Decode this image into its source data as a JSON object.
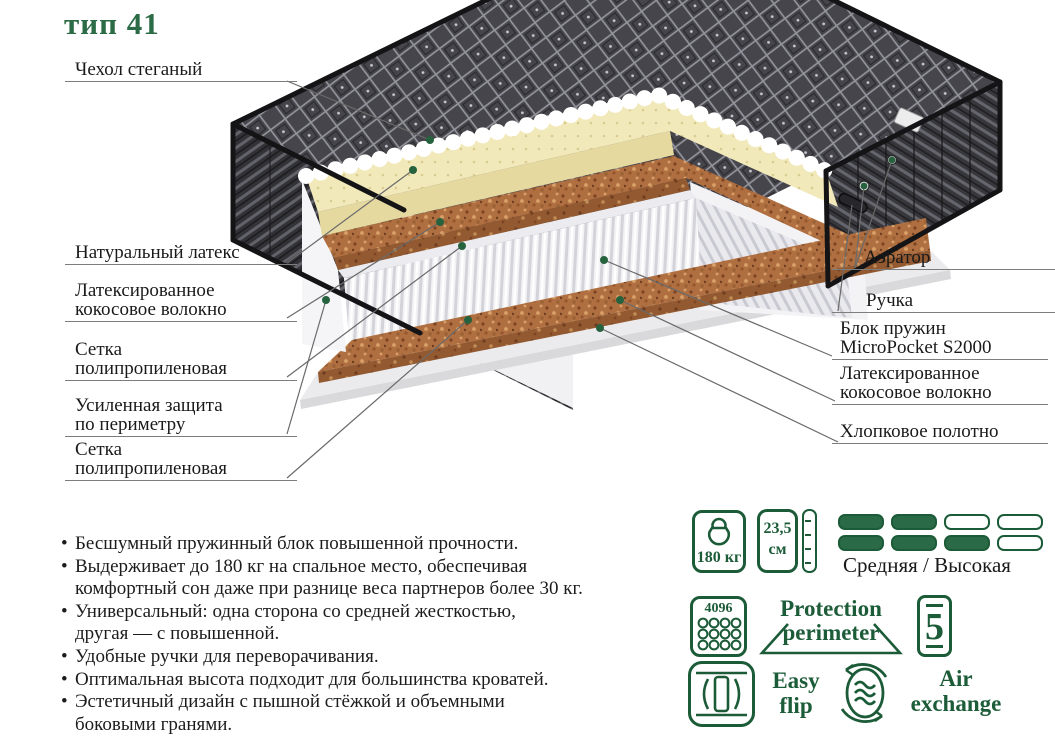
{
  "title": "тип 41",
  "labels_left": [
    [
      "Чехол стеганый"
    ],
    [
      "Натуральный латекс"
    ],
    [
      "Латексированное",
      "кокосовое волокно"
    ],
    [
      "Сетка",
      "полипропиленовая"
    ],
    [
      "Усиленная защита",
      "по периметру"
    ],
    [
      "Сетка",
      "полипропиленовая"
    ]
  ],
  "labels_right": [
    [
      "Аэратор"
    ],
    [
      "Ручка"
    ],
    [
      "Блок пружин",
      "MicroPocket S2000"
    ],
    [
      "Латексированное",
      "кокосовое волокно"
    ],
    [
      "Хлопковое полотно"
    ]
  ],
  "bullets": [
    [
      "Бесшумный пружинный блок повышенной прочности."
    ],
    [
      "Выдерживает до 180 кг на спальное место, обеспечивая",
      "комфортный сон даже при разнице веса партнеров более 30 кг."
    ],
    [
      "Универсальный: одна сторона со средней жесткостью,",
      "другая — с повышенной."
    ],
    [
      "Удобные ручки для переворачивания."
    ],
    [
      "Оптимальная высота подходит для большинства кроватей."
    ],
    [
      "Эстетичный дизайн с пышной стёжкой и объемными",
      "боковыми гранями."
    ]
  ],
  "specs": {
    "max_weight": "180 кг",
    "height_value": "23,5",
    "height_unit": "см",
    "springs_count": "4096",
    "firmness_label": "Средняя / Высокая",
    "firmness_pattern": [
      [
        true,
        true,
        false,
        false
      ],
      [
        true,
        true,
        true,
        false
      ]
    ],
    "protection_line1": "Protection",
    "protection_line2": "perimeter",
    "warranty_years": "5",
    "flip_line1": "Easy",
    "flip_line2": "flip",
    "air_line1": "Air",
    "air_line2": "exchange"
  },
  "icons": {
    "weight": "kettlebell-icon",
    "height": "ruler-icon",
    "springs": "pocket-springs-icon",
    "warranty": "warranty-5-badge",
    "flip": "easy-flip-icon",
    "air": "air-exchange-icon"
  },
  "colors": {
    "accent_green": "#1c5b38",
    "title_green": "#2b6b45",
    "latex": "#f2e9bb",
    "coir": "#b06f41",
    "cover_dark": "#45454b"
  }
}
